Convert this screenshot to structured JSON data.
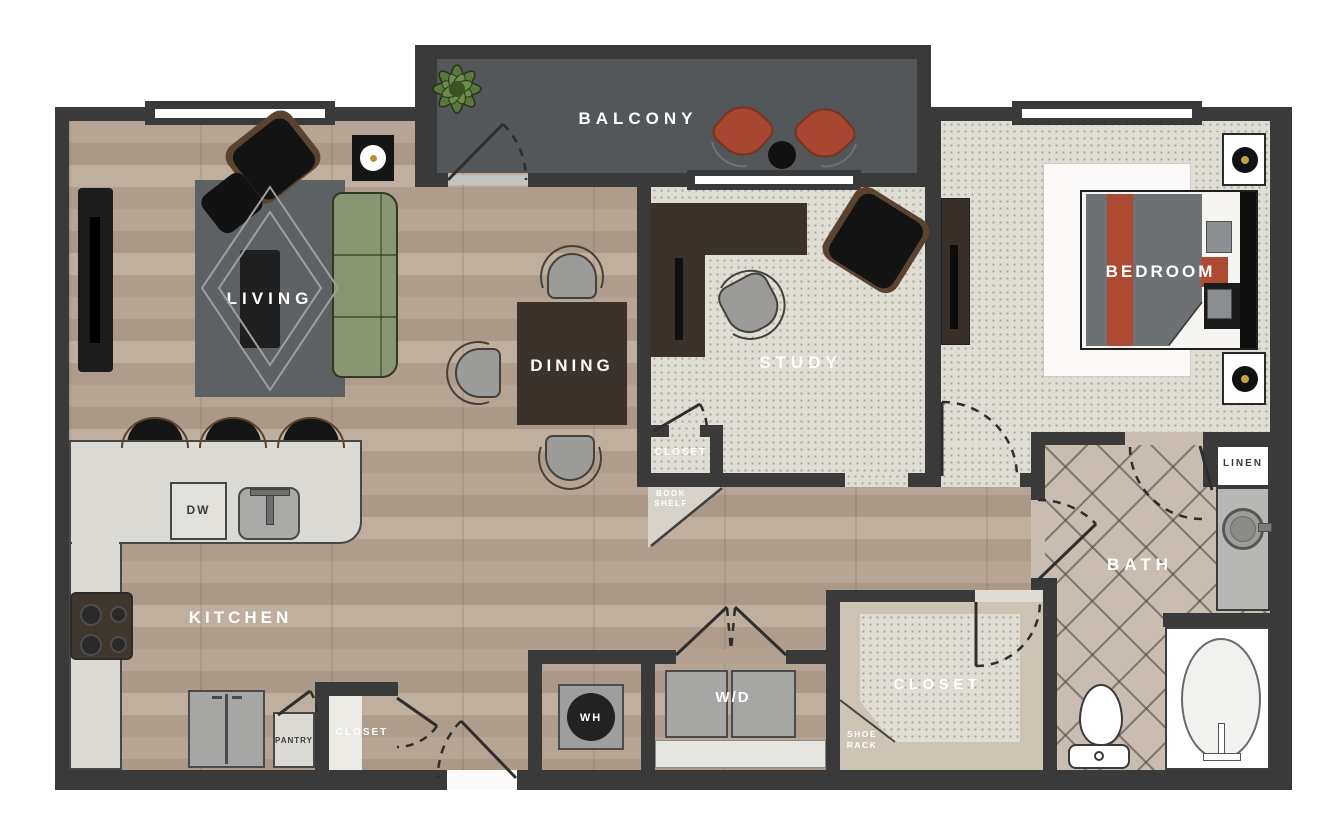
{
  "plan_labels": {
    "balcony": "BALCONY",
    "living": "LIVING",
    "dining": "DINING",
    "study": "STUDY",
    "bedroom": "BEDROOM",
    "kitchen": "KITCHEN",
    "bath": "BATH",
    "walk_in_closet": "CLOSET",
    "study_closet": "CLOSET",
    "hall_closet": "CLOSET",
    "linen": "LINEN",
    "pantry": "PANTRY",
    "book_shelf": "BOOK\nSHELF",
    "shoe_rack": "SHOE\nRACK",
    "washer_dryer": "W/D",
    "water_heater": "WH",
    "dishwasher": "DW"
  },
  "colors": {
    "wall": "#3a3a3a",
    "wood_floor": "#b2a191",
    "carpet": "#e0ddd5",
    "bath_tile": "#c9bdb1",
    "balcony_floor": "#53575a",
    "accent_red": "#ae4a32",
    "sofa_green": "#8a9572",
    "rug_gray": "#5d6164",
    "counter": "#dcdad5",
    "appliance_gray": "#a6a6a4"
  }
}
